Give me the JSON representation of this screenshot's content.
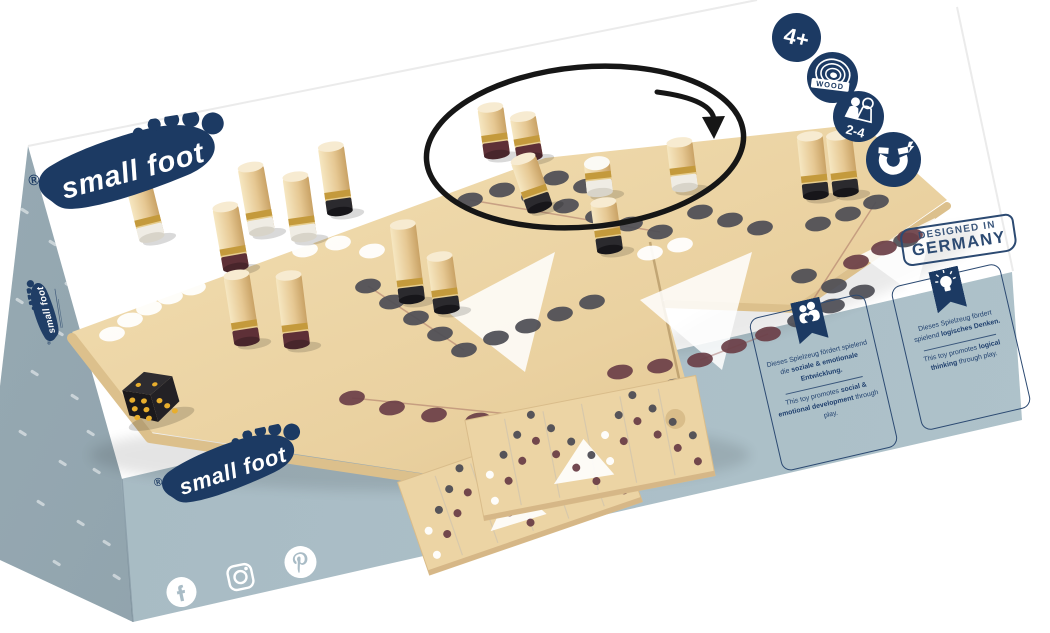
{
  "meta": {
    "brand": "small foot",
    "registered": "®"
  },
  "badges": {
    "age": "4+",
    "material": "WOOD",
    "players": "2-4",
    "feature": "magnet"
  },
  "stamp": {
    "line1": "DESIGNED IN",
    "line2": "GERMANY"
  },
  "front": {
    "panels": [
      {
        "icon": "family-heart-icon",
        "de": [
          {
            "t": "Dieses Spielzeug fördert spielend die ",
            "b": 0
          },
          {
            "t": "soziale & emotionale Entwicklung.",
            "b": 1
          }
        ],
        "en": [
          {
            "t": "This toy promotes ",
            "b": 0
          },
          {
            "t": "social & emotional development",
            "b": 1
          },
          {
            "t": " through play.",
            "b": 0
          }
        ]
      },
      {
        "icon": "lightbulb-icon",
        "de": [
          {
            "t": "Dieses Spielzeug fördert spielend ",
            "b": 0
          },
          {
            "t": "logisches Denken.",
            "b": 1
          }
        ],
        "en": [
          {
            "t": "This toy promotes ",
            "b": 0
          },
          {
            "t": "logical thinking",
            "b": 1
          },
          {
            "t": " through play.",
            "b": 0
          }
        ]
      }
    ],
    "social": [
      "facebook",
      "instagram",
      "pinterest"
    ]
  },
  "colors": {
    "navy": "#1c3a63",
    "frontFace": "#a9bcc6",
    "leftFace": "#90a3ad",
    "wood": "#ecd4a4",
    "woodLight": "#f3e2ba",
    "woodEdge": "#dcc08c",
    "gold": "#c49a3c",
    "dotDark": "#4e4d55",
    "dotMaroon": "#6c3f48",
    "dotWhite": "#ffffff",
    "pegWhite": "#efece4",
    "pegBlack": "#2b2a2e",
    "pegMaroon": "#5e3037",
    "dieBlack": "#1b191c",
    "pip": "#e8ae2d",
    "annotation": "#161616"
  },
  "scene": {
    "board": {
      "outline": [
        [
          72,
          332
        ],
        [
          545,
          158
        ],
        [
          862,
          124
        ],
        [
          947,
          200
        ],
        [
          795,
          306
        ],
        [
          663,
          300
        ],
        [
          704,
          446
        ],
        [
          480,
          482
        ],
        [
          150,
          432
        ]
      ],
      "seam": [
        [
          650,
          242
        ],
        [
          690,
          430
        ]
      ],
      "frontEdgeLeft": [
        [
          72,
          338
        ],
        [
          150,
          438
        ],
        [
          478,
          487
        ],
        [
          700,
          450
        ]
      ],
      "frontEdgeRight": [
        [
          947,
          206
        ],
        [
          797,
          309
        ],
        [
          666,
          304
        ]
      ],
      "triangles": [
        [
          [
            445,
            310
          ],
          [
            555,
            252
          ],
          [
            525,
            372
          ]
        ],
        [
          [
            640,
            300
          ],
          [
            752,
            252
          ],
          [
            722,
            370
          ]
        ],
        [
          [
            860,
            255
          ],
          [
            935,
            218
          ],
          [
            915,
            295
          ]
        ]
      ],
      "lines": [
        [
          [
            352,
            398
          ],
          [
            568,
            420
          ]
        ],
        [
          [
            368,
            286
          ],
          [
            464,
            350
          ]
        ],
        [
          [
            470,
            200
          ],
          [
            660,
            232
          ]
        ],
        [
          [
            700,
            360
          ],
          [
            768,
            334
          ]
        ],
        [
          [
            800,
            320
          ],
          [
            876,
            202
          ]
        ]
      ],
      "dots": [
        [
          112,
          334,
          "w"
        ],
        [
          130,
          320,
          "w"
        ],
        [
          149,
          308,
          "w"
        ],
        [
          170,
          297,
          "w"
        ],
        [
          193,
          288,
          "w"
        ],
        [
          305,
          250,
          "w"
        ],
        [
          338,
          243,
          "w"
        ],
        [
          372,
          251,
          "w"
        ],
        [
          650,
          253,
          "w"
        ],
        [
          680,
          245,
          "w"
        ],
        [
          368,
          286,
          "k"
        ],
        [
          392,
          302,
          "k"
        ],
        [
          416,
          318,
          "k"
        ],
        [
          440,
          334,
          "k"
        ],
        [
          464,
          350,
          "k"
        ],
        [
          496,
          338,
          "k"
        ],
        [
          528,
          326,
          "k"
        ],
        [
          560,
          314,
          "k"
        ],
        [
          592,
          302,
          "k"
        ],
        [
          606,
          412,
          "k"
        ],
        [
          642,
          400,
          "k"
        ],
        [
          674,
          386,
          "k"
        ],
        [
          800,
          320,
          "k"
        ],
        [
          832,
          306,
          "k"
        ],
        [
          862,
          292,
          "k"
        ],
        [
          470,
          200,
          "k"
        ],
        [
          502,
          190,
          "k"
        ],
        [
          534,
          196,
          "k"
        ],
        [
          566,
          206,
          "k"
        ],
        [
          598,
          216,
          "k"
        ],
        [
          630,
          224,
          "k"
        ],
        [
          660,
          232,
          "k"
        ],
        [
          700,
          212,
          "k"
        ],
        [
          730,
          220,
          "k"
        ],
        [
          760,
          228,
          "k"
        ],
        [
          818,
          224,
          "k"
        ],
        [
          848,
          214,
          "k"
        ],
        [
          876,
          202,
          "k"
        ],
        [
          556,
          178,
          "k"
        ],
        [
          586,
          186,
          "k"
        ],
        [
          804,
          276,
          "k"
        ],
        [
          834,
          286,
          "k"
        ],
        [
          906,
          240,
          "k"
        ],
        [
          352,
          398,
          "m"
        ],
        [
          392,
          408,
          "m"
        ],
        [
          434,
          415,
          "m"
        ],
        [
          478,
          420,
          "m"
        ],
        [
          524,
          422,
          "m"
        ],
        [
          568,
          420,
          "m"
        ],
        [
          620,
          372,
          "m"
        ],
        [
          660,
          366,
          "m"
        ],
        [
          700,
          360,
          "m"
        ],
        [
          734,
          346,
          "m"
        ],
        [
          768,
          334,
          "m"
        ],
        [
          856,
          262,
          "m"
        ],
        [
          884,
          248,
          "m"
        ],
        [
          910,
          236,
          "m"
        ]
      ]
    },
    "pegs": [
      [
        497,
        155,
        48,
        -8,
        "m"
      ],
      [
        530,
        158,
        42,
        -10,
        "m"
      ],
      [
        685,
        188,
        46,
        -7,
        "w"
      ],
      [
        600,
        193,
        30,
        -6,
        "t"
      ],
      [
        846,
        193,
        58,
        -7,
        "k"
      ],
      [
        816,
        196,
        60,
        -6,
        "k"
      ],
      [
        540,
        208,
        52,
        -19,
        "k"
      ],
      [
        340,
        212,
        66,
        -8,
        "k"
      ],
      [
        262,
        232,
        66,
        -10,
        "w"
      ],
      [
        152,
        238,
        60,
        -14,
        "w"
      ],
      [
        304,
        238,
        62,
        -8,
        "w"
      ],
      [
        610,
        250,
        48,
        -8,
        "k"
      ],
      [
        236,
        268,
        62,
        -10,
        "m"
      ],
      [
        412,
        300,
        76,
        -7,
        "k"
      ],
      [
        447,
        310,
        54,
        -8,
        "k"
      ],
      [
        247,
        342,
        68,
        -9,
        "m"
      ],
      [
        297,
        345,
        70,
        -7,
        "m"
      ]
    ],
    "die": {
      "x": 150,
      "y": 393,
      "rot": -16,
      "faces": {
        "left": 6,
        "right": 3,
        "top": 2
      }
    },
    "prints": [
      {
        "cx": 520,
        "cy": 492,
        "w": 225,
        "h": 98,
        "rot": -19
      },
      {
        "cx": 590,
        "cy": 448,
        "w": 235,
        "h": 102,
        "rot": -11
      }
    ],
    "annotation": {
      "circle": {
        "cx": 585,
        "cy": 147,
        "rx": 159,
        "ry": 80,
        "rot": -5,
        "width": 5.5
      },
      "arrow": {
        "path": [
          [
            657,
            92
          ],
          [
            696,
            97
          ],
          [
            713,
            107
          ],
          [
            714,
            120
          ]
        ],
        "head": [
          [
            702,
            117
          ],
          [
            725,
            116
          ],
          [
            714,
            139
          ]
        ]
      }
    },
    "speckles": [
      [
        20,
        210
      ],
      [
        48,
        242
      ],
      [
        15,
        300
      ],
      [
        55,
        332
      ],
      [
        30,
        372
      ],
      [
        70,
        396
      ],
      [
        18,
        432
      ],
      [
        58,
        462
      ],
      [
        92,
        470
      ],
      [
        36,
        502
      ],
      [
        76,
        522
      ],
      [
        102,
        542
      ],
      [
        52,
        562
      ],
      [
        112,
        576
      ],
      [
        86,
        432
      ],
      [
        106,
        382
      ],
      [
        96,
        342
      ],
      [
        116,
        302
      ],
      [
        40,
        180
      ],
      [
        64,
        284
      ]
    ],
    "creases": [
      [
        [
          28,
          146
        ],
        [
          757,
          0
        ]
      ],
      [
        [
          957,
          7
        ],
        [
          1013,
          271
        ]
      ]
    ]
  }
}
